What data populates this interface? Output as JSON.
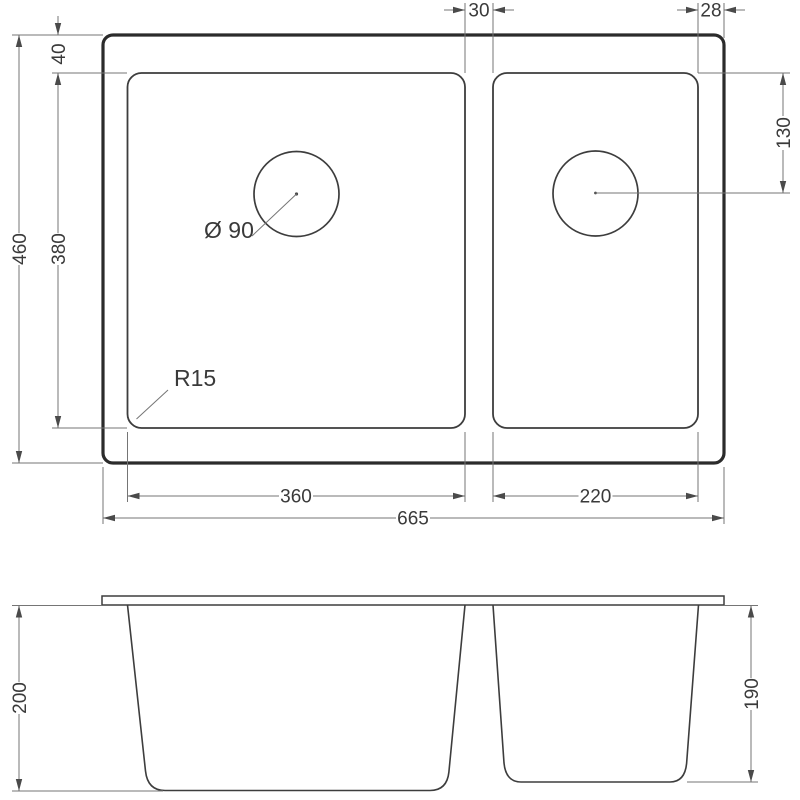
{
  "colors": {
    "background": "#ffffff",
    "outline": "#2b2b2b",
    "part_line": "#3d3d3d",
    "dimension_line": "#757575",
    "text": "#3a3a3a"
  },
  "top_view": {
    "dim_divider_width": "30",
    "dim_right_margin": "28",
    "dim_top_margin": "40",
    "dim_overall_depth": "460",
    "dim_bowl_depth": "380",
    "dim_drain_offset": "130",
    "dim_left_bowl_width": "360",
    "dim_right_bowl_width": "220",
    "dim_overall_width": "665",
    "label_drain_diameter": "Ø 90",
    "label_corner_radius": "R15"
  },
  "front_view": {
    "dim_left_bowl_depth": "200",
    "dim_right_bowl_depth": "190"
  }
}
